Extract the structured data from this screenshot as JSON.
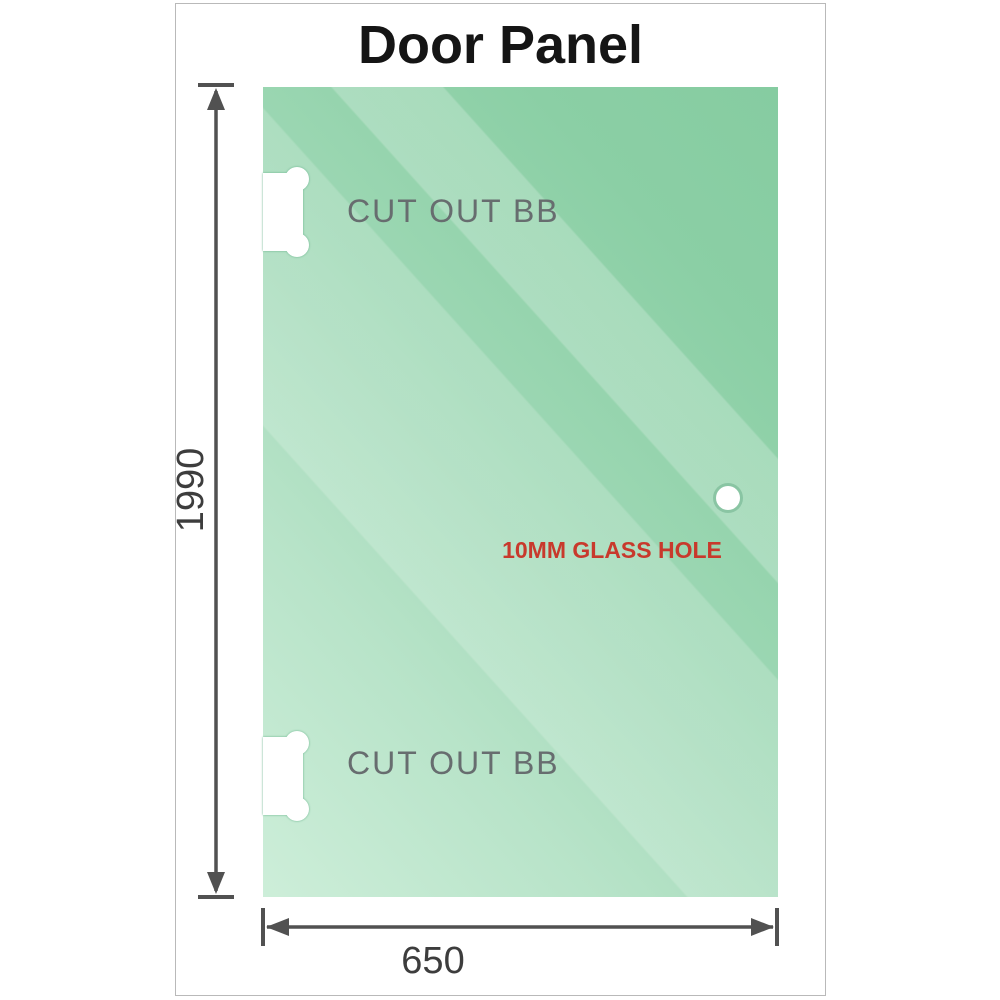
{
  "title": "Door Panel",
  "panel": {
    "glass_color_light": "#cdeed9",
    "glass_color_dark": "#86cca1",
    "label_color": "#676d6f",
    "cutouts": [
      {
        "label": "CUT OUT BB",
        "position": "top-left-edge"
      },
      {
        "label": "CUT OUT BB",
        "position": "bottom-left-edge"
      }
    ],
    "hole": {
      "label": "10MM GLASS HOLE",
      "label_color": "#c8392c",
      "position": "middle-right-edge"
    }
  },
  "dimensions": {
    "height": {
      "label": "1990",
      "orientation": "vertical"
    },
    "width": {
      "label": "650",
      "orientation": "horizontal"
    },
    "line_color": "#515151",
    "text_color": "#3d3d3d"
  }
}
